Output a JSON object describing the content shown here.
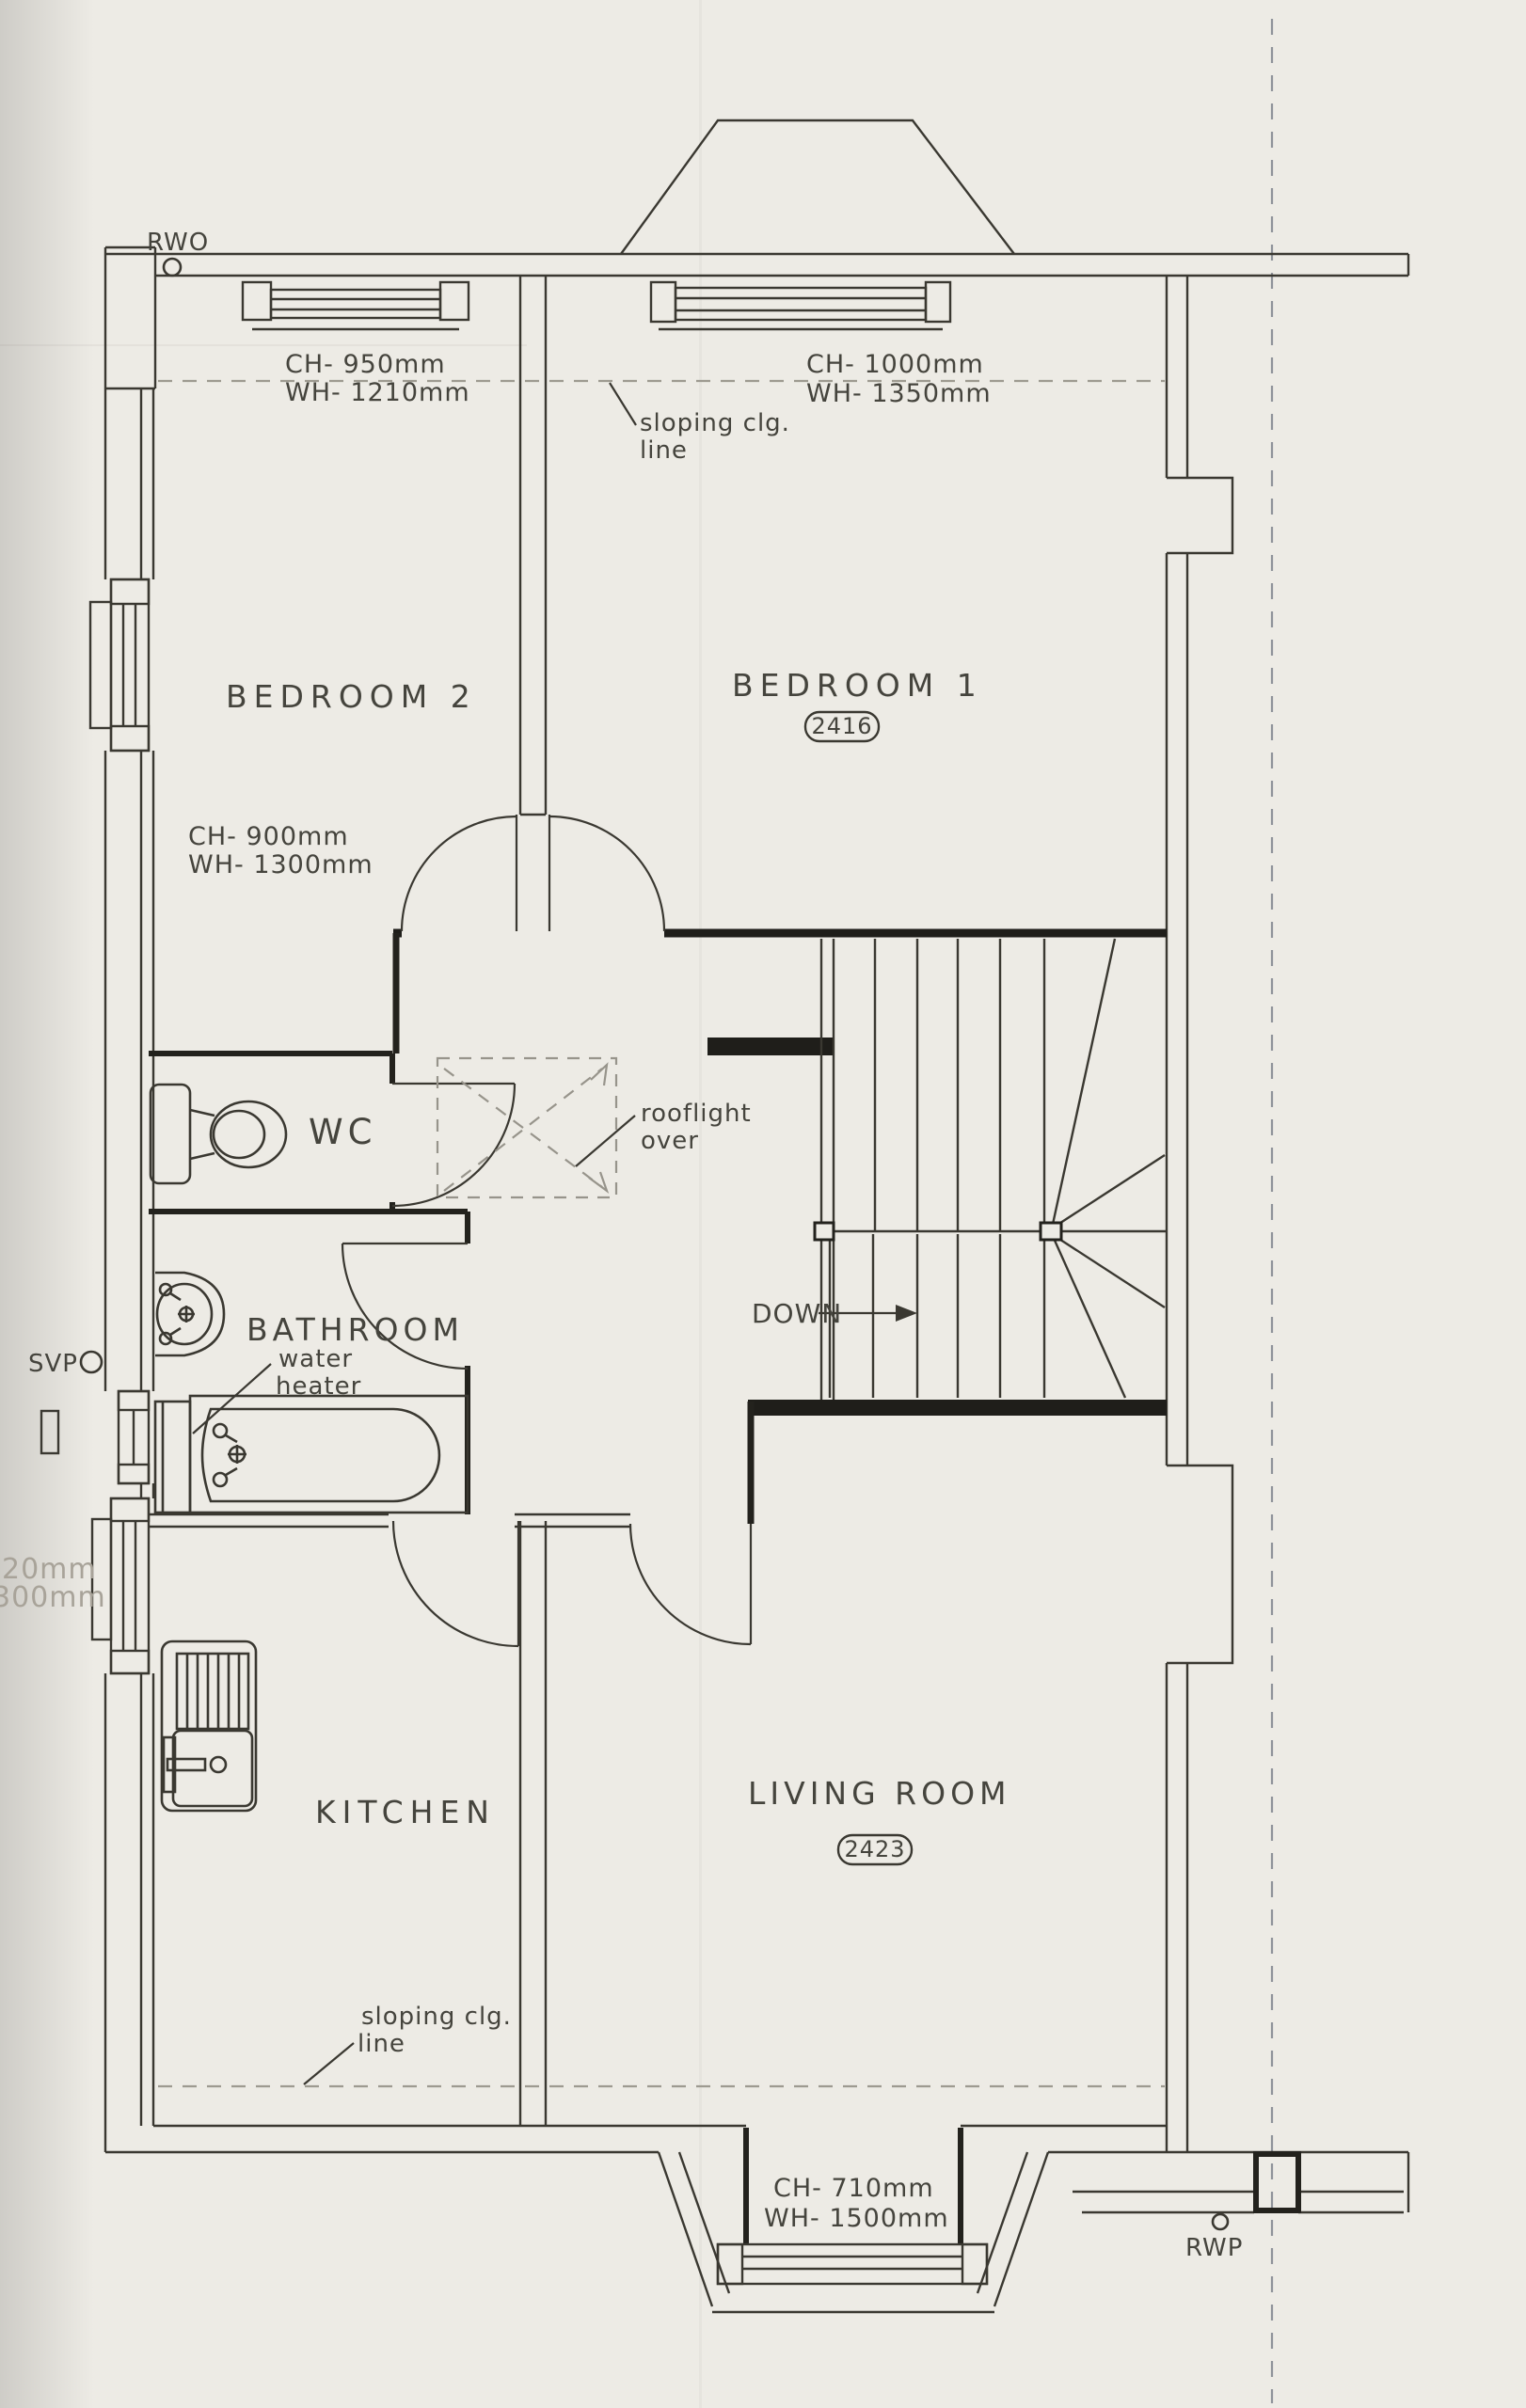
{
  "drawing": {
    "paper_color": "#edebe5",
    "line_color": "#3a3831",
    "dashed_color": "#9d9a90",
    "boundary_dash_color": "#8f939a",
    "faded_text_color": "#a8a399"
  },
  "labels": {
    "rwo": "RWO",
    "svp": "SVP",
    "rwp": "RWP",
    "down": "DOWN",
    "rooflight_l1": "rooflight",
    "rooflight_l2": "over",
    "water_heater_l1": "water",
    "water_heater_l2": "heater",
    "sloping_top_l1": "sloping clg.",
    "sloping_top_l2": "line",
    "sloping_bottom_l1": "sloping clg.",
    "sloping_bottom_l2": "line",
    "edge_partial_l1": "20mm",
    "edge_partial_l2": "300mm"
  },
  "rooms": {
    "bedroom2": {
      "name": "BEDROOM 2",
      "ch": "CH-  900mm",
      "wh": "WH-  1300mm"
    },
    "bedroom1": {
      "name": "BEDROOM 1",
      "code": "2416"
    },
    "wc": {
      "name": "WC"
    },
    "bathroom": {
      "name": "BATHROOM"
    },
    "kitchen": {
      "name": "KITCHEN"
    },
    "living_room": {
      "name": "LIVING ROOM",
      "code": "2423"
    }
  },
  "windows": {
    "bedroom2_front": {
      "ch": "CH-  950mm",
      "wh": "WH-  1210mm"
    },
    "bedroom1_front": {
      "ch": "CH-  1000mm",
      "wh": "WH-  1350mm"
    },
    "living_bay": {
      "ch": "CH-  710mm",
      "wh": "WH-  1500mm"
    }
  }
}
